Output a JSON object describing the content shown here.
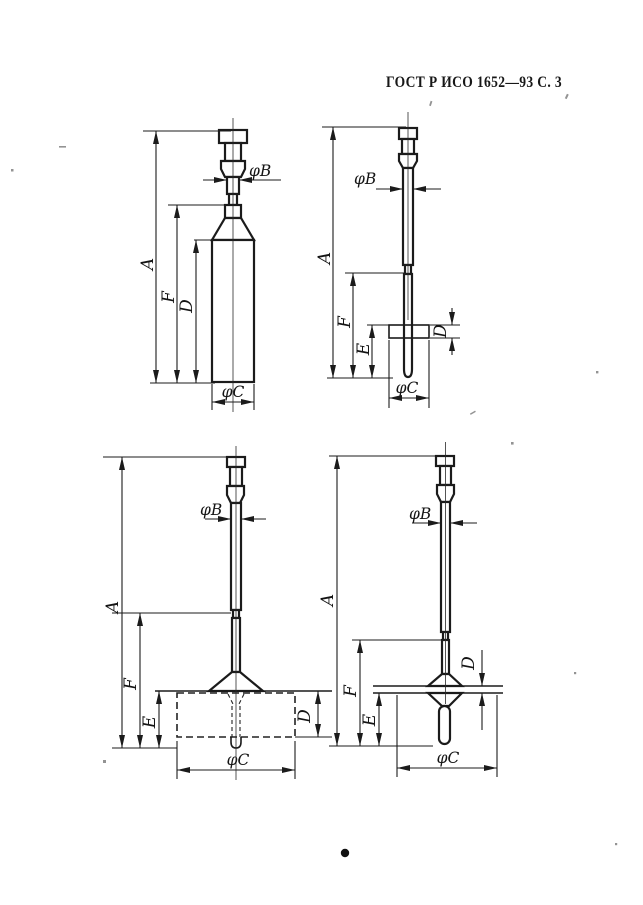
{
  "document": {
    "header": "ГОСТ Р ИСО 1652—93 С. 3"
  },
  "dimension_labels": {
    "A": "A",
    "F": "F",
    "D": "D",
    "E": "E",
    "phiB": "φB",
    "phiC": "φC"
  },
  "figures": [
    {
      "id": "spindle-top-left",
      "shape": "cylinder-bob",
      "labels": [
        "A",
        "F",
        "D",
        "φB",
        "φC"
      ]
    },
    {
      "id": "spindle-top-right",
      "shape": "small-disc-bob",
      "labels": [
        "A",
        "F",
        "E",
        "D",
        "φB",
        "φC"
      ]
    },
    {
      "id": "spindle-bottom-left",
      "shape": "wide-cup-bob",
      "labels": [
        "A",
        "F",
        "E",
        "D",
        "φB",
        "φC"
      ]
    },
    {
      "id": "spindle-bottom-right",
      "shape": "cone-disc-bob",
      "labels": [
        "A",
        "F",
        "E",
        "D",
        "φB",
        "φC"
      ]
    }
  ]
}
